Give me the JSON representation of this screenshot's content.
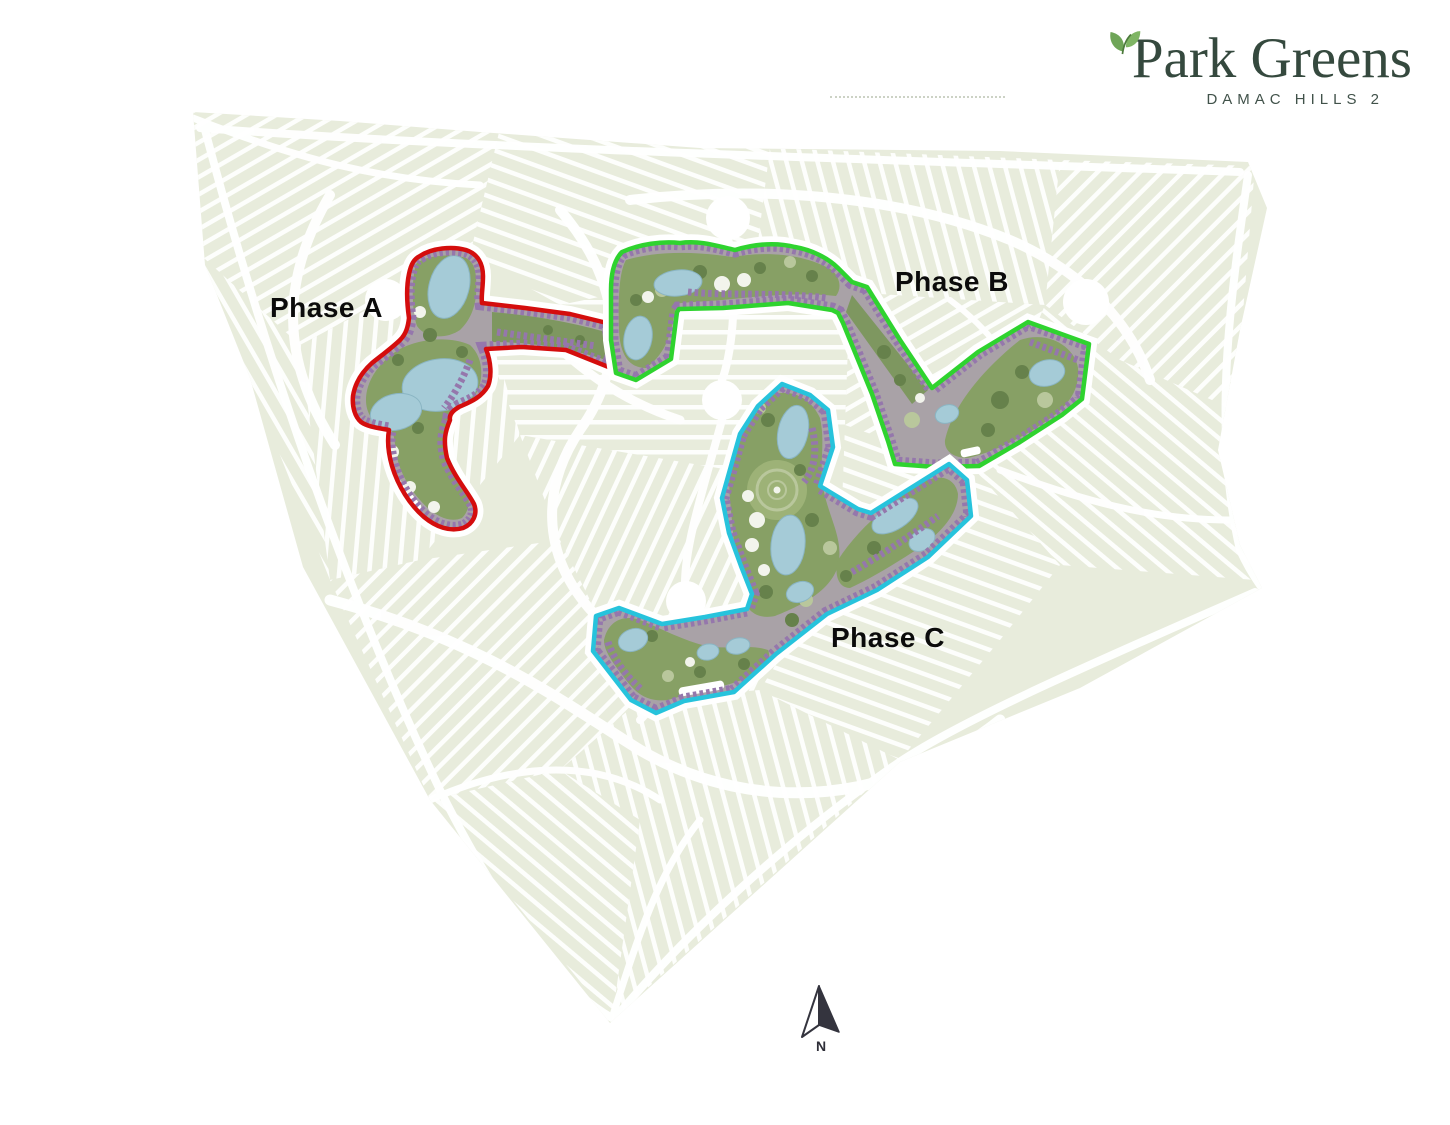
{
  "logo": {
    "title": "Park Greens",
    "subtitle": "DAMAC HILLS 2",
    "brand_color": "#35493e",
    "leaf_color": "#6fa558"
  },
  "map": {
    "name": "Park Greens DAMAC Hills 2 masterplan",
    "colors": {
      "community_base": "#e8ecdc",
      "streets": "#ffffff",
      "development_ground": "#a9a2a7",
      "townhouse_rows": "#9577ac",
      "water": "#a5cbd7",
      "greenery": "#87a065"
    }
  },
  "phases": [
    {
      "id": "phase-a",
      "label": "Phase A",
      "outline_color": "#d40d0d"
    },
    {
      "id": "phase-b",
      "label": "Phase B",
      "outline_color": "#2fd32f"
    },
    {
      "id": "phase-c",
      "label": "Phase C",
      "outline_color": "#27c3dc"
    }
  ],
  "compass": {
    "label": "N"
  }
}
